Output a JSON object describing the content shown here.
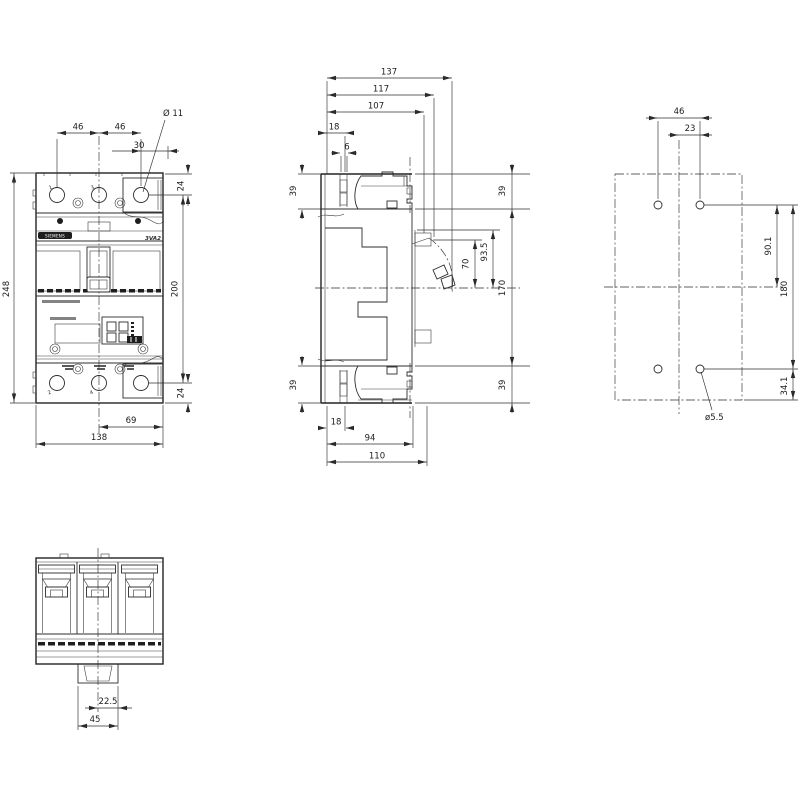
{
  "drawing_type": "dimensional technical drawing - molded case circuit breaker",
  "colors": {
    "line": "#2c2c2c",
    "text": "#1c1c1c",
    "background": "#ffffff"
  },
  "labels": {
    "brand": "SIEMENS",
    "model": "3VA2",
    "t1": "1",
    "t3": "3",
    "t2": "2",
    "t4": "4"
  },
  "dims": {
    "front": {
      "d46a": "46",
      "d46b": "46",
      "d30": "30",
      "dia11": "Ø 11",
      "d24t": "24",
      "d200": "200",
      "d24b": "24",
      "d248": "248",
      "d69": "69",
      "d138": "138"
    },
    "side": {
      "d137": "137",
      "d117": "117",
      "d107": "107",
      "d18t": "18",
      "d6": "6",
      "d39tl": "39",
      "d39tr": "39",
      "d935": "93.5",
      "d70": "70",
      "d170": "170",
      "d39bl": "39",
      "d39br": "39",
      "d18b": "18",
      "d94": "94",
      "d110": "110"
    },
    "drill": {
      "d46": "46",
      "d23": "23",
      "d901": "90.1",
      "d180": "180",
      "d341": "34.1",
      "dia55": "ø5.5"
    },
    "bottom": {
      "d225": "22.5",
      "d45": "45"
    }
  }
}
